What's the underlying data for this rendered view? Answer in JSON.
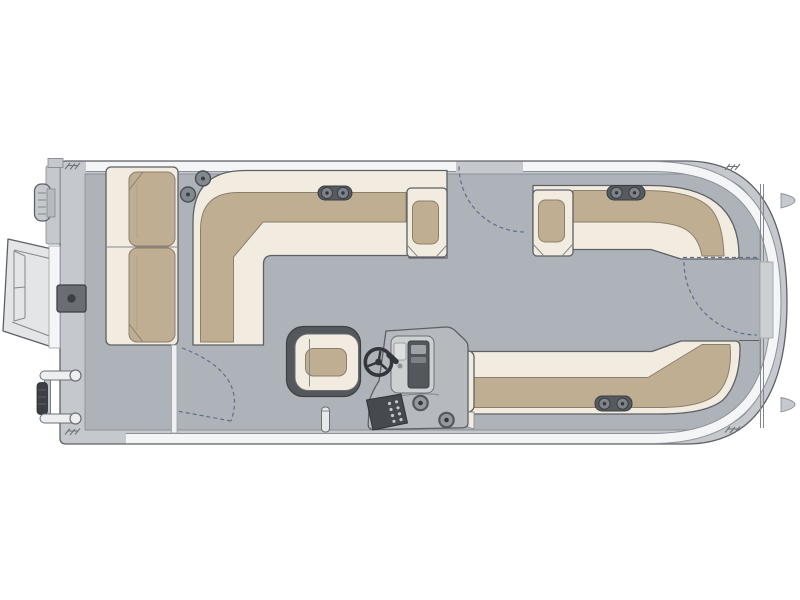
{
  "meta": {
    "title": "Pontoon boat floor plan - top view",
    "canvas": {
      "width": 800,
      "height": 600
    }
  },
  "colors": {
    "background": "#ffffff",
    "hull": "#c5c8cc",
    "deck": "#aeb3b9",
    "rail": "#f4f5f6",
    "upholstery_base": "#f1ecdf",
    "upholstery_cushion": "#c0ae92",
    "outline": "#5d6166",
    "dark_trim": "#54585d",
    "hardware": "#84898e",
    "panel": "#cdd0d1",
    "console": "#b6b9bd",
    "swing": "#5e6f8e",
    "ramp": "#e3e5e7",
    "gate_door": "#cdd0d3"
  },
  "parts": [
    {
      "name": "hull-outline",
      "label": "Pontoon deck and fence"
    },
    {
      "name": "boarding-ramp",
      "label": "Stern boarding ramp"
    },
    {
      "name": "outboard-motor",
      "label": "Outboard motor"
    },
    {
      "name": "swim-ladder",
      "label": "Swim ladder"
    },
    {
      "name": "stern-chaise",
      "label": "Stern chaise lounge"
    },
    {
      "name": "aft-l-lounge",
      "label": "Aft port L-lounge"
    },
    {
      "name": "bow-port-lounge",
      "label": "Bow port lounge"
    },
    {
      "name": "bow-starboard-lounge",
      "label": "Bow starboard lounge"
    },
    {
      "name": "captains-chair",
      "label": "Captain's chair"
    },
    {
      "name": "helm-console",
      "label": "Helm console"
    },
    {
      "name": "steering-wheel-icon",
      "label": "Steering wheel"
    },
    {
      "name": "gate-swing-top",
      "label": "Port gate swing"
    },
    {
      "name": "gate-swing-bow",
      "label": "Bow gate swing"
    },
    {
      "name": "gate-swing-aft",
      "label": "Starboard aft gate swing"
    },
    {
      "name": "cleat-icon",
      "label": "Mooring cleat"
    },
    {
      "name": "speaker-icon",
      "label": "Speaker"
    }
  ]
}
